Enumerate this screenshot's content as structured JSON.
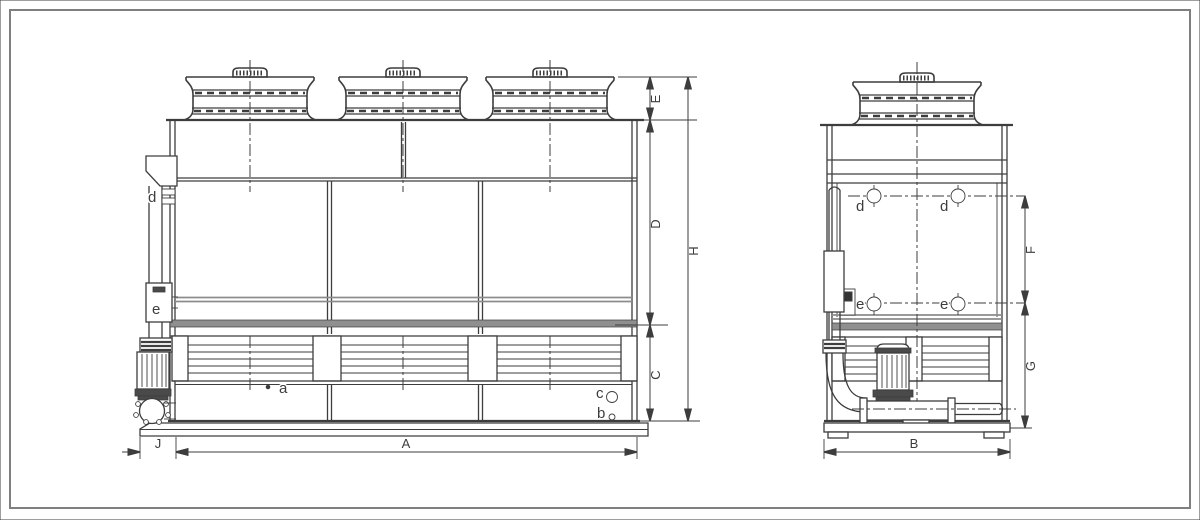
{
  "front_view": {
    "connection_labels": {
      "d": "d",
      "e": "e",
      "a": "a",
      "b": "b",
      "c": "c"
    },
    "dimension_labels": {
      "E": "E",
      "D": "D",
      "H": "H",
      "C": "C",
      "J": "J",
      "A": "A"
    }
  },
  "side_view": {
    "connection_labels": {
      "d": "d",
      "e": "e"
    },
    "dimension_labels": {
      "F": "F",
      "G": "G",
      "B": "B"
    }
  },
  "colors": {
    "line": "#3d3d3d",
    "gray_strip": "#8f8f8f",
    "gray_line": "#8c8c8c",
    "dark_fill": "#4a4a4a",
    "sheet_frame": "#7f7f7f",
    "background": "#ffffff"
  }
}
